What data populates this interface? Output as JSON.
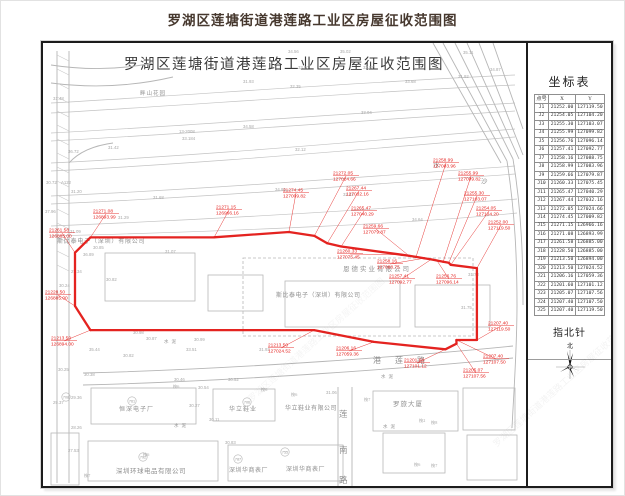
{
  "page_title": "罗湖区莲塘街道港莲路工业区房屋征收范围图",
  "map": {
    "title": "罗湖区莲塘街道港莲路工业区房屋征收范围图",
    "watermark": "罗湖区莲塘街道港莲路工业区房屋征收范围图",
    "place_labels": [
      {
        "text": "畔山花园",
        "x": 97,
        "y": 52,
        "fs": 5.5,
        "ls": 1
      },
      {
        "text": "恩德实业有限公司",
        "x": 300,
        "y": 228,
        "fs": 6.5,
        "ls": 2
      },
      {
        "text": "斯比泰电子（深圳）有限公司",
        "x": 233,
        "y": 254,
        "fs": 6,
        "ls": 0.5
      },
      {
        "text": "斯比泰电子（深圳）有限公司",
        "x": 14,
        "y": 200,
        "fs": 6,
        "ls": 0.8
      },
      {
        "text": "恒深电子厂",
        "x": 76,
        "y": 368,
        "fs": 6,
        "ls": 1
      },
      {
        "text": "华立鞋业",
        "x": 186,
        "y": 368,
        "fs": 6,
        "ls": 1
      },
      {
        "text": "华立鞋业有限公司",
        "x": 242,
        "y": 367,
        "fs": 6,
        "ls": 0.5
      },
      {
        "text": "罗旅大厦",
        "x": 350,
        "y": 363,
        "fs": 6.5,
        "ls": 1
      },
      {
        "text": "深圳环球电品有限公司",
        "x": 73,
        "y": 430,
        "fs": 6.5,
        "ls": 0.5
      },
      {
        "text": "深圳华商表厂",
        "x": 186,
        "y": 429,
        "fs": 6,
        "ls": 0.5
      },
      {
        "text": "深圳华商表厂",
        "x": 243,
        "y": 428,
        "fs": 6,
        "ls": 0.5
      },
      {
        "text": "水",
        "x": 390,
        "y": 124,
        "fs": 6.5,
        "ls": 0
      },
      {
        "text": "沙",
        "x": 438,
        "y": 140,
        "fs": 6.5,
        "ls": 0
      },
      {
        "text": "水泥",
        "x": 131,
        "y": 384,
        "fs": 4.5,
        "ls": 3
      },
      {
        "text": "水泥",
        "x": 340,
        "y": 385,
        "fs": 4.5,
        "ls": 3
      },
      {
        "text": "水泥",
        "x": 121,
        "y": 300,
        "fs": 4.5,
        "ls": 3
      },
      {
        "text": "水泥",
        "x": 338,
        "y": 335,
        "fs": 4.5,
        "ls": 3
      }
    ],
    "street_h": {
      "text": "港 莲 路",
      "x": 330,
      "y": 320,
      "fs": 8
    },
    "street_v": {
      "chars": [
        "莲",
        "南",
        "路"
      ],
      "x": 296,
      "ys": [
        374,
        410,
        440
      ],
      "fs": 8.5
    },
    "elevation_labels": [
      [
        10,
        57,
        "31.48"
      ],
      [
        200,
        40,
        "31.93"
      ],
      [
        247,
        45,
        "32.35"
      ],
      [
        255,
        26,
        "33.90"
      ],
      [
        320,
        26,
        "32.97"
      ],
      [
        362,
        40,
        "33.68"
      ],
      [
        415,
        35,
        "31.92"
      ],
      [
        420,
        11,
        "35.11"
      ],
      [
        245,
        10,
        "34.56"
      ],
      [
        297,
        10,
        "35.02"
      ],
      [
        447,
        28,
        "34.87"
      ],
      [
        318,
        71,
        "33.04"
      ],
      [
        136,
        90,
        "13-2008"
      ],
      [
        139,
        97,
        "33.184"
      ],
      [
        25,
        110,
        "36.72"
      ],
      [
        65,
        106,
        "31.42"
      ],
      [
        252,
        108,
        "32.12"
      ],
      [
        200,
        85,
        "34.58"
      ],
      [
        300,
        153,
        "32.22"
      ],
      [
        232,
        148,
        "34.99"
      ],
      [
        110,
        156,
        "31.68"
      ],
      [
        28,
        150,
        "31.20"
      ],
      [
        75,
        176,
        "31.29"
      ],
      [
        3,
        141,
        "30.72"
      ],
      [
        18,
        141,
        "A122"
      ],
      [
        2,
        170,
        "37.96"
      ],
      [
        27,
        190,
        "31.09"
      ],
      [
        50,
        206,
        "30.85"
      ],
      [
        40,
        213,
        "36.89"
      ],
      [
        28,
        230,
        "27.34"
      ],
      [
        16,
        244,
        "30.24"
      ],
      [
        63,
        238,
        "30.82"
      ],
      [
        122,
        210,
        "31.07"
      ],
      [
        369,
        178,
        "34.64"
      ],
      [
        418,
        266,
        "31.75"
      ],
      [
        425,
        233,
        "31.78"
      ],
      [
        90,
        291,
        "30.98"
      ],
      [
        103,
        297,
        "30.87"
      ],
      [
        151,
        298,
        "30.99"
      ],
      [
        143,
        308,
        "33.51"
      ],
      [
        216,
        308,
        "31.93"
      ],
      [
        80,
        314,
        "30.82"
      ],
      [
        46,
        308,
        "35.44"
      ],
      [
        15,
        328,
        "30.25"
      ],
      [
        41,
        333,
        "30.38"
      ],
      [
        131,
        338,
        "30.46"
      ],
      [
        185,
        338,
        "30.52"
      ],
      [
        155,
        346,
        "30.54"
      ],
      [
        146,
        364,
        "30.27"
      ],
      [
        166,
        378,
        "30.11"
      ],
      [
        28,
        356,
        "29.36"
      ],
      [
        28,
        386,
        "28.26"
      ],
      [
        25,
        409,
        "27.53"
      ],
      [
        10,
        361,
        "29.37"
      ],
      [
        182,
        401,
        "30.83"
      ],
      [
        283,
        351,
        "31.06"
      ]
    ],
    "tree_labels": [
      [
        130,
        345,
        "桉6"
      ],
      [
        218,
        348,
        "桉6"
      ],
      [
        248,
        353,
        "桉6"
      ],
      [
        321,
        358,
        "桉7"
      ],
      [
        376,
        379,
        "桉2"
      ],
      [
        388,
        381,
        "桉8"
      ],
      [
        371,
        423,
        "桉6"
      ],
      [
        388,
        424,
        "桉7"
      ],
      [
        41,
        434,
        "桉7"
      ],
      [
        100,
        413,
        "桉6"
      ]
    ],
    "circled_numbers": [
      [
        89,
        358,
        "761"
      ],
      [
        204,
        359,
        "706"
      ],
      [
        242,
        409,
        "755"
      ],
      [
        100,
        414,
        "792"
      ],
      [
        195,
        416,
        "787"
      ],
      [
        23,
        354,
        "708"
      ]
    ]
  },
  "boundary": {
    "color": "#e42320",
    "points": [
      {
        "id": "J1",
        "x": "21252.00",
        "y": "127119.50"
      },
      {
        "id": "J2",
        "x": "21254.05",
        "y": "127104.20"
      },
      {
        "id": "J3",
        "x": "21255.30",
        "y": "127103.07"
      },
      {
        "id": "J4",
        "x": "21255.99",
        "y": "127099.82"
      },
      {
        "id": "J5",
        "x": "21256.76",
        "y": "127096.14"
      },
      {
        "id": "J6",
        "x": "21257.41",
        "y": "127092.77"
      },
      {
        "id": "J7",
        "x": "21258.16",
        "y": "127088.75"
      },
      {
        "id": "J8",
        "x": "21258.99",
        "y": "127083.96"
      },
      {
        "id": "J9",
        "x": "21259.66",
        "y": "127079.87"
      },
      {
        "id": "J10",
        "x": "21260.33",
        "y": "127075.45"
      },
      {
        "id": "J11",
        "x": "21265.47",
        "y": "127040.29"
      },
      {
        "id": "J12",
        "x": "21267.44",
        "y": "127032.16"
      },
      {
        "id": "J13",
        "x": "21272.05",
        "y": "127024.66"
      },
      {
        "id": "J14",
        "x": "21274.45",
        "y": "127009.82"
      },
      {
        "id": "J15",
        "x": "21271.15",
        "y": "126966.16"
      },
      {
        "id": "J16",
        "x": "21271.08",
        "y": "126893.99"
      },
      {
        "id": "J17",
        "x": "21261.58",
        "y": "126885.00"
      },
      {
        "id": "J18",
        "x": "21228.50",
        "y": "126885.00"
      },
      {
        "id": "J19",
        "x": "21213.50",
        "y": "126894.00"
      },
      {
        "id": "J20",
        "x": "21213.50",
        "y": "127024.52"
      },
      {
        "id": "J21",
        "x": "21206.16",
        "y": "127059.36"
      },
      {
        "id": "J22",
        "x": "21201.60",
        "y": "127101.12"
      },
      {
        "id": "J23",
        "x": "21205.07",
        "y": "127107.56"
      },
      {
        "id": "J24",
        "x": "21207.40",
        "y": "127107.50"
      },
      {
        "id": "J25",
        "x": "21207.40",
        "y": "127119.50"
      }
    ]
  },
  "sidebar": {
    "table_title": "坐标表",
    "columns": [
      "点号",
      "X",
      "Y"
    ],
    "compass_label": "指北针",
    "compass_north": "北"
  }
}
